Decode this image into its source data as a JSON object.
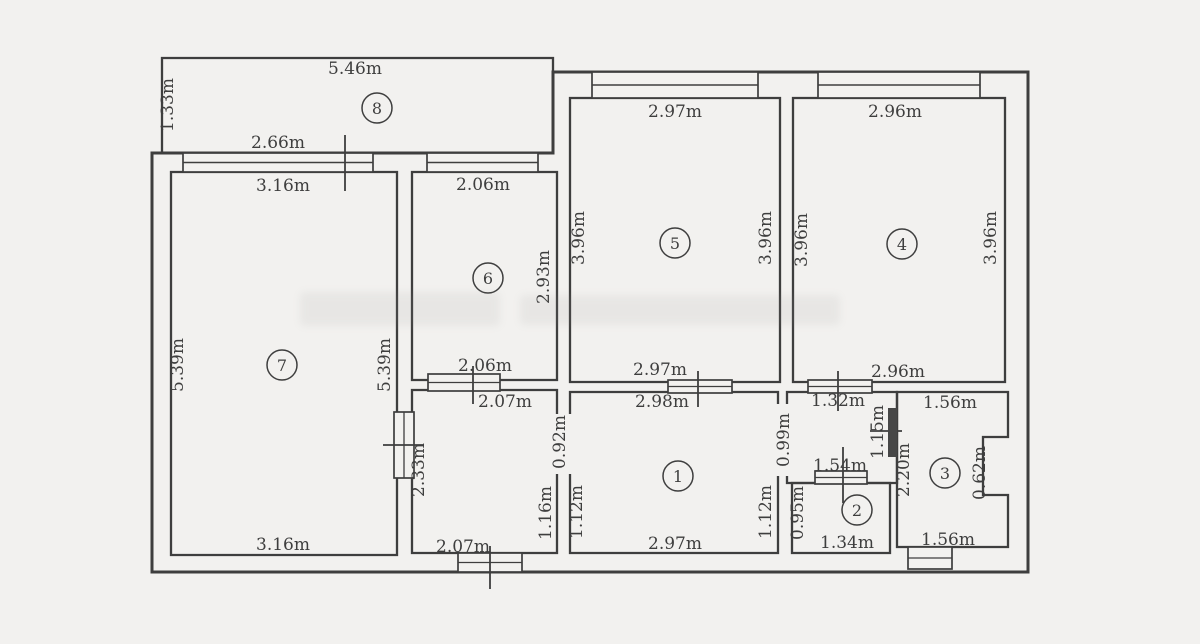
{
  "meta": {
    "type": "apartment-floor-plan",
    "unit": "m"
  },
  "colors": {
    "background": "#f2f1ef",
    "line": "#3e3e3e",
    "dark_door": "#474747"
  },
  "rooms": [
    {
      "number": "1",
      "width_label": "2.98m",
      "width_label_alt": "2.97m",
      "marker": {
        "x": 678,
        "y": 476
      }
    },
    {
      "number": "2",
      "width_label": "1.34m",
      "height_label": "0.95m",
      "marker": {
        "x": 857,
        "y": 510
      }
    },
    {
      "number": "3",
      "width_label": "1.56m",
      "height_label": "2.20m",
      "marker": {
        "x": 945,
        "y": 473
      }
    },
    {
      "number": "4",
      "width_label": "2.96m",
      "height_label": "3.96m",
      "marker": {
        "x": 902,
        "y": 244
      }
    },
    {
      "number": "5",
      "width_label": "2.97m",
      "height_label": "3.96m",
      "marker": {
        "x": 675,
        "y": 243
      }
    },
    {
      "number": "6",
      "width_label": "2.06m",
      "height_label": "2.93m",
      "marker": {
        "x": 488,
        "y": 278
      }
    },
    {
      "number": "7",
      "width_label": "3.16m",
      "height_label": "5.39m",
      "marker": {
        "x": 282,
        "y": 365
      }
    },
    {
      "number": "8",
      "width_label": "5.46m",
      "height_label": "1.33m",
      "marker": {
        "x": 377,
        "y": 108
      }
    }
  ],
  "dimension_labels": [
    {
      "text": "5.46m",
      "x": 355,
      "y": 74,
      "vertical": false
    },
    {
      "text": "2.66m",
      "x": 278,
      "y": 148,
      "vertical": false
    },
    {
      "text": "3.16m",
      "x": 283,
      "y": 191,
      "vertical": false
    },
    {
      "text": "2.06m",
      "x": 483,
      "y": 190,
      "vertical": false
    },
    {
      "text": "2.97m",
      "x": 675,
      "y": 117,
      "vertical": false
    },
    {
      "text": "2.96m",
      "x": 895,
      "y": 117,
      "vertical": false
    },
    {
      "text": "2.06m",
      "x": 485,
      "y": 371,
      "vertical": false
    },
    {
      "text": "2.97m",
      "x": 660,
      "y": 375,
      "vertical": false
    },
    {
      "text": "2.96m",
      "x": 898,
      "y": 377,
      "vertical": false
    },
    {
      "text": "2.07m",
      "x": 505,
      "y": 407,
      "vertical": false
    },
    {
      "text": "2.98m",
      "x": 662,
      "y": 407,
      "vertical": false
    },
    {
      "text": "1.32m",
      "x": 838,
      "y": 406,
      "vertical": false
    },
    {
      "text": "1.56m",
      "x": 950,
      "y": 408,
      "vertical": false
    },
    {
      "text": "1.54m",
      "x": 840,
      "y": 471,
      "vertical": false
    },
    {
      "text": "2.07m",
      "x": 463,
      "y": 552,
      "vertical": false
    },
    {
      "text": "2.97m",
      "x": 675,
      "y": 549,
      "vertical": false
    },
    {
      "text": "1.34m",
      "x": 847,
      "y": 548,
      "vertical": false
    },
    {
      "text": "1.56m",
      "x": 948,
      "y": 545,
      "vertical": false
    },
    {
      "text": "3.16m",
      "x": 283,
      "y": 550,
      "vertical": false
    },
    {
      "text": "1.33m",
      "x": 173,
      "y": 105,
      "vertical": true
    },
    {
      "text": "5.39m",
      "x": 183,
      "y": 365,
      "vertical": true
    },
    {
      "text": "5.39m",
      "x": 390,
      "y": 365,
      "vertical": true
    },
    {
      "text": "2.93m",
      "x": 549,
      "y": 277,
      "vertical": true
    },
    {
      "text": "3.96m",
      "x": 584,
      "y": 238,
      "vertical": true
    },
    {
      "text": "3.96m",
      "x": 771,
      "y": 238,
      "vertical": true
    },
    {
      "text": "3.96m",
      "x": 807,
      "y": 240,
      "vertical": true
    },
    {
      "text": "3.96m",
      "x": 996,
      "y": 238,
      "vertical": true
    },
    {
      "text": "2.33m",
      "x": 424,
      "y": 470,
      "vertical": true
    },
    {
      "text": "0.92m",
      "x": 565,
      "y": 442,
      "vertical": true
    },
    {
      "text": "1.16m",
      "x": 551,
      "y": 513,
      "vertical": true
    },
    {
      "text": "1.12m",
      "x": 582,
      "y": 512,
      "vertical": true
    },
    {
      "text": "0.99m",
      "x": 789,
      "y": 440,
      "vertical": true
    },
    {
      "text": "1.12m",
      "x": 771,
      "y": 512,
      "vertical": true
    },
    {
      "text": "1.15m",
      "x": 883,
      "y": 432,
      "vertical": true
    },
    {
      "text": "2.20m",
      "x": 909,
      "y": 470,
      "vertical": true
    },
    {
      "text": "0.62m",
      "x": 985,
      "y": 473,
      "vertical": true
    },
    {
      "text": "0.95m",
      "x": 803,
      "y": 513,
      "vertical": true
    }
  ],
  "geometry": {
    "outer_wall": "M152,153 L553,153 L553,72 L1028,72 L1028,572 L152,572 Z",
    "room_outlines": [
      {
        "name": "balcony-8",
        "d": "M162,58 H553 V153 H162 Z"
      },
      {
        "name": "room-7",
        "d": "M171,172 H397 V555 H171 Z"
      },
      {
        "name": "room-6",
        "d": "M412,172 H557 V380 H412 Z"
      },
      {
        "name": "room-5",
        "d": "M570,98 H780 V382 H570 Z"
      },
      {
        "name": "room-4",
        "d": "M793,98 H1005 V382 H793 Z"
      },
      {
        "name": "hall-left",
        "d": "M412,390 H557 V553 H412 Z"
      },
      {
        "name": "room-1",
        "d": "M570,392 H778 V553 H570 Z"
      },
      {
        "name": "hall-right",
        "d": "M787,392 H897 V483 H787 Z"
      },
      {
        "name": "room-2",
        "d": "M792,483 H890 V553 H792 Z"
      },
      {
        "name": "room-3",
        "d": "M897,392 H1008 V437 H983 V495 H1008 V547 H897 Z"
      }
    ],
    "wall_openings": [
      {
        "x": 554,
        "y": 414,
        "w": 19,
        "h": 60
      },
      {
        "x": 775,
        "y": 404,
        "w": 15,
        "h": 72
      }
    ],
    "windows": [
      {
        "x": 183,
        "y": 153,
        "w": 190,
        "h": 19
      },
      {
        "x": 427,
        "y": 153,
        "w": 111,
        "h": 19
      },
      {
        "x": 592,
        "y": 72,
        "w": 166,
        "h": 26
      },
      {
        "x": 818,
        "y": 72,
        "w": 162,
        "h": 26
      }
    ],
    "doors": [
      {
        "x": 394,
        "y": 412,
        "w": 20,
        "h": 66,
        "tick": {
          "x1": 383,
          "y1": 445,
          "x2": 424,
          "y2": 445
        }
      },
      {
        "x": 428,
        "y": 374,
        "w": 72,
        "h": 17,
        "tick": {
          "x1": 473,
          "y1": 366,
          "x2": 473,
          "y2": 404
        }
      },
      {
        "x": 668,
        "y": 380,
        "w": 64,
        "h": 13,
        "tick": {
          "x1": 698,
          "y1": 371,
          "x2": 698,
          "y2": 407
        }
      },
      {
        "x": 808,
        "y": 380,
        "w": 64,
        "h": 13,
        "tick": {
          "x1": 838,
          "y1": 371,
          "x2": 838,
          "y2": 411
        }
      },
      {
        "x": 815,
        "y": 471,
        "w": 52,
        "h": 13,
        "tick": {
          "x1": 843,
          "y1": 447,
          "x2": 843,
          "y2": 503
        }
      },
      {
        "x": 458,
        "y": 553,
        "w": 64,
        "h": 19,
        "tick": {
          "x1": 490,
          "y1": 546,
          "x2": 490,
          "y2": 589
        }
      },
      {
        "x": 908,
        "y": 547,
        "w": 44,
        "h": 22,
        "tick": null
      }
    ],
    "dark_door": {
      "x": 888,
      "y": 408,
      "w": 9,
      "h": 49
    },
    "ticks": [
      {
        "x1": 345,
        "y1": 135,
        "x2": 345,
        "y2": 191
      },
      {
        "x1": 870,
        "y1": 431,
        "x2": 902,
        "y2": 431
      }
    ]
  }
}
